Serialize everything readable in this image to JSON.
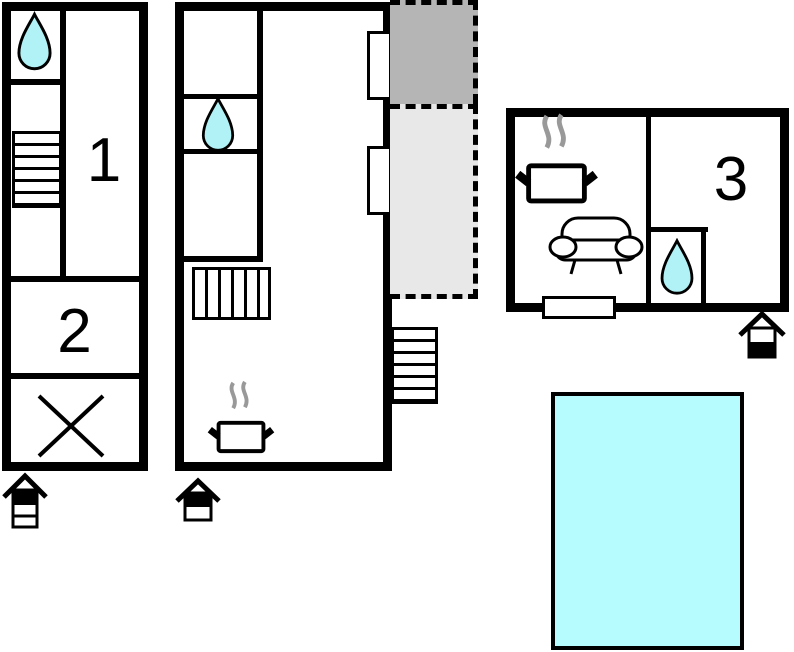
{
  "document": {
    "type": "floor-plan",
    "background": "#ffffff"
  },
  "rooms": {
    "room1": {
      "label": "1"
    },
    "room2": {
      "label": "2"
    },
    "room3": {
      "label": "3"
    }
  },
  "colors": {
    "wall": "#000000",
    "water": "#b0f2f5",
    "pool": "#b6fcff",
    "terrace_dark": "#b5b5b5",
    "terrace_light": "#e8e8e8",
    "steam": "#999999"
  },
  "icons": {
    "water-drop-icon": "cyan teardrop (bath / shower)",
    "cooking-pot-icon": "pot with steam (kitchen / stove)",
    "sofa-icon": "sofa outline (living area)",
    "stairs-icon": "striped rectangle (staircase)",
    "cross-icon": "X mark (unused / void area)",
    "entrance-icon": "small house with band (entrance marker)",
    "window-marker": "white rectangle on wall (window / door)",
    "pool-area": "cyan rectangle (swimming pool)",
    "terrace-area": "gray dashed outdoor area (terrace / balcony)"
  }
}
